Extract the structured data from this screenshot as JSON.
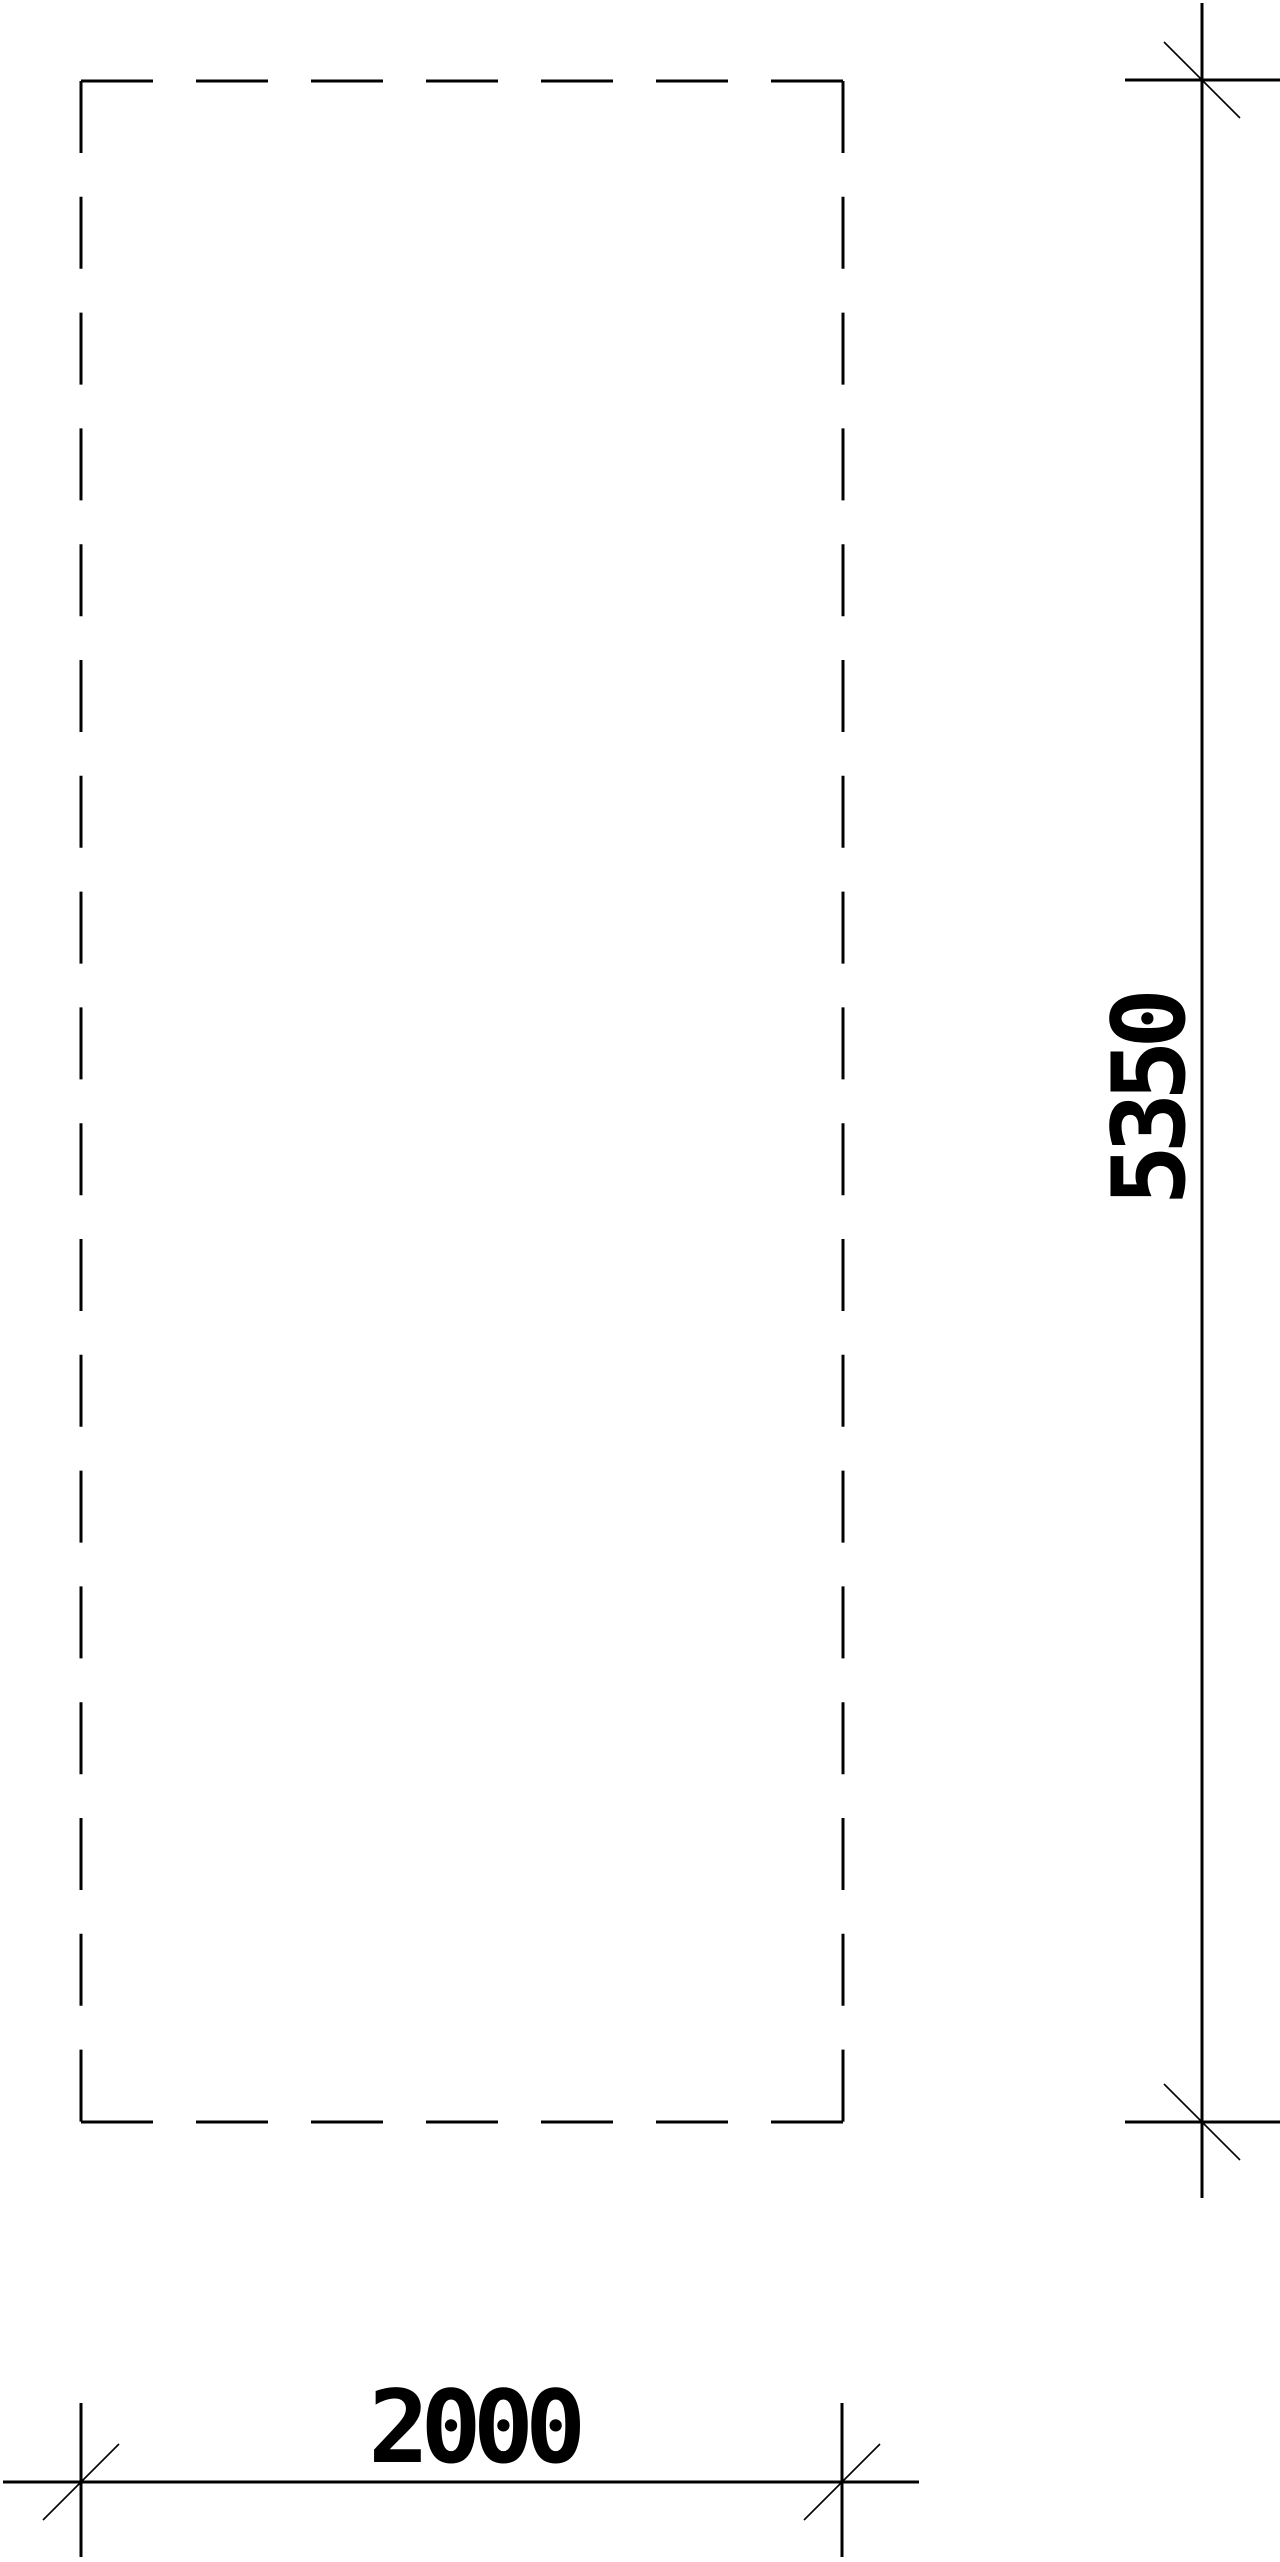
{
  "drawing": {
    "background_color": "#ffffff",
    "line_color": "#000000",
    "object": {
      "style": "dashed-outline-rectangle"
    },
    "dimensions": {
      "height": {
        "value": "5350",
        "orientation": "vertical"
      },
      "width": {
        "value": "2000",
        "orientation": "horizontal"
      }
    }
  }
}
